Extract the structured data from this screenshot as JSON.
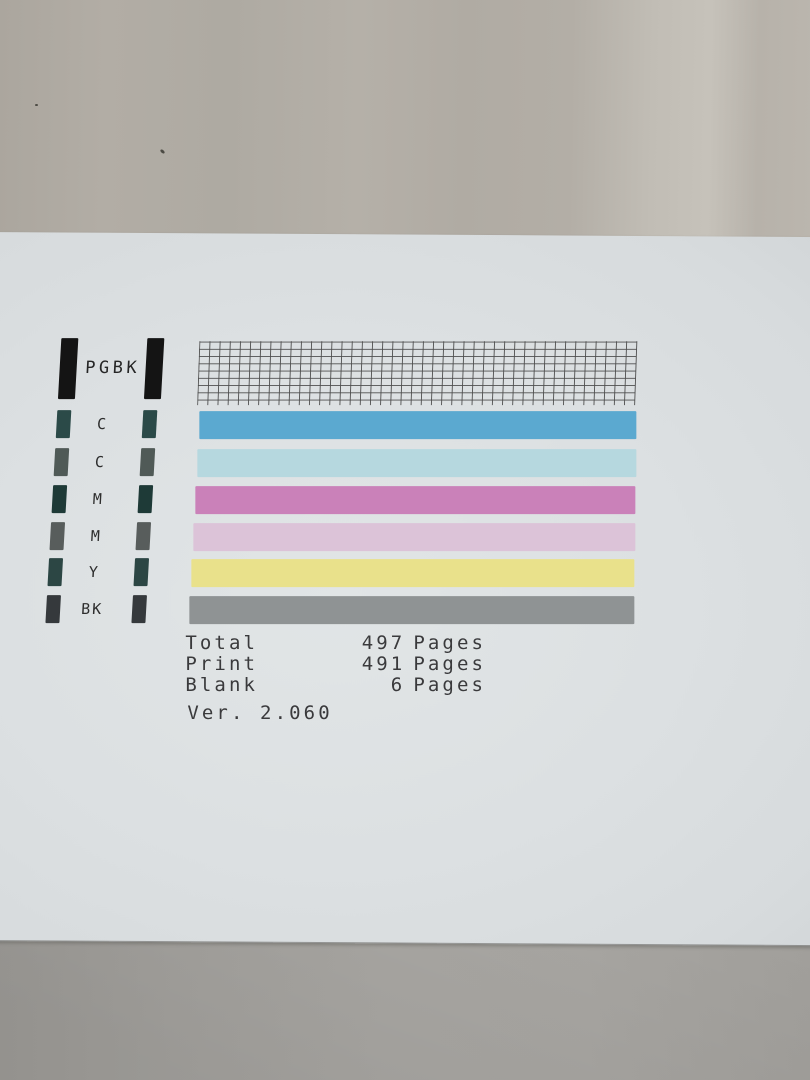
{
  "scene": {
    "description": "Photograph of a printer nozzle check test page lying on gray fabric",
    "fabric_top_color": "#b2ada5",
    "fabric_bottom_color": "#a7a5a1",
    "paper_color": "#dce0e2"
  },
  "pattern": {
    "pgbk_label": "PGBK",
    "pgbk_bar_color": "#141414",
    "grid": {
      "columns": 44,
      "rows": 8,
      "line_color": "#4f4f4f"
    },
    "rows": [
      {
        "label": "C",
        "swatch_color": "#2b4a48",
        "bar_color": "#5ba9d0"
      },
      {
        "label": "C",
        "swatch_color": "#505a57",
        "bar_color": "#b6d8df"
      },
      {
        "label": "M",
        "swatch_color": "#1e3a37",
        "bar_color": "#ca81b9"
      },
      {
        "label": "M",
        "swatch_color": "#585d5c",
        "bar_color": "#dcc3d8"
      },
      {
        "label": "Y",
        "swatch_color": "#2c4644",
        "bar_color": "#e9e18b"
      },
      {
        "label": "BK",
        "swatch_color": "#35393c",
        "bar_color": "#8f9394"
      }
    ]
  },
  "counters": {
    "rows": [
      {
        "label": "Total",
        "value": "497",
        "unit": "Pages"
      },
      {
        "label": "Print",
        "value": "491",
        "unit": "Pages"
      },
      {
        "label": "Blank",
        "value": "6",
        "unit": "Pages"
      }
    ],
    "version": "Ver. 2.060"
  }
}
